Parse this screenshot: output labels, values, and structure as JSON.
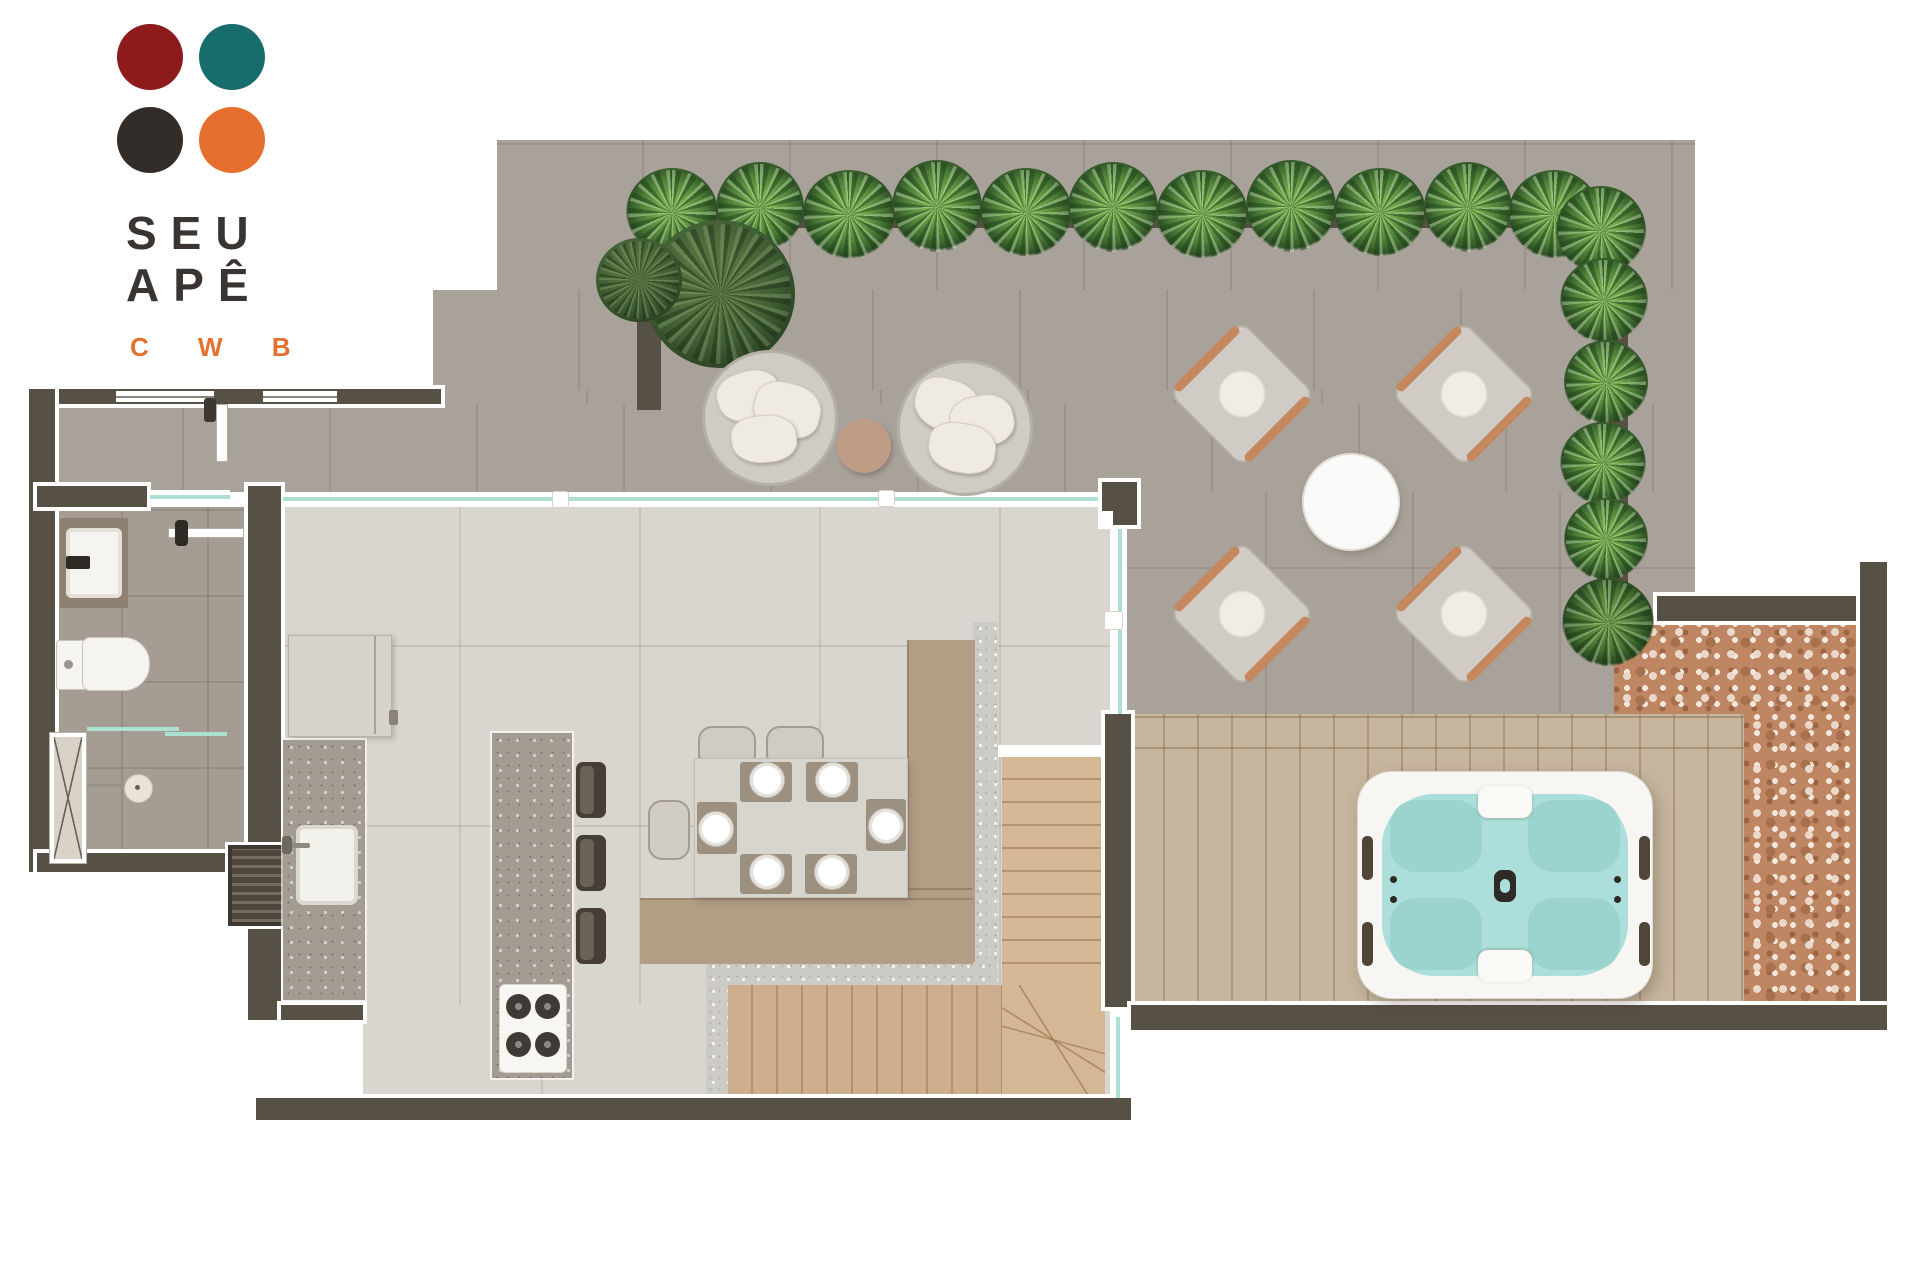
{
  "logo": {
    "line1": "SEU",
    "line2": "APÊ",
    "tagline": "C W B"
  },
  "palette": {
    "logo-red": "#8E1B1B",
    "logo-teal": "#176D6B",
    "logo-dark": "#332D2A",
    "logo-orange": "#E56F2E",
    "wall": "#575044",
    "terrace": "#A9A29A",
    "interior": "#D9D6CF",
    "bath-floor": "#A59D94",
    "granite": "#A49C92",
    "pony": "#CDCBC6",
    "wood-deck": "#C7B69E",
    "stair-wood": "#D4B794",
    "stair-wood-low": "#CDAF8F",
    "pebble": "#BE8663",
    "water": "#ACDFDB",
    "water-seat": "#9BD3CE",
    "tan-bench": "#B49D85",
    "glass": "#ABE0D2",
    "copper": "#C5885E",
    "chair-gray": "#D0CCC5",
    "cushion": "#EFEAE2",
    "mat": "#9C9081"
  }
}
